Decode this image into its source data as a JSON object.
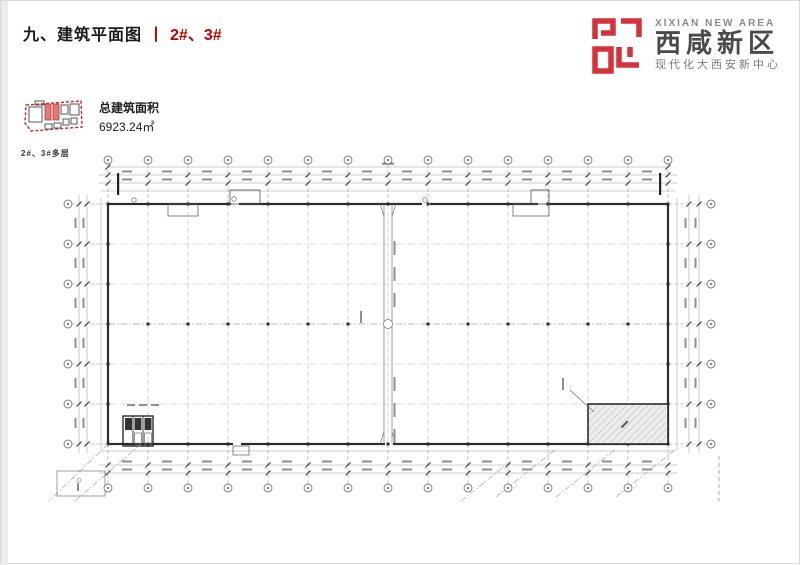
{
  "slide": {
    "title": "九、建筑平面图",
    "title_separator": "丨",
    "title_highlight": "2#、3#",
    "accent_color": "#c00000"
  },
  "logo": {
    "name_en": "XIXIAN NEW AREA",
    "name_cn": "西咸新区",
    "tagline": "现代化大西安新中心",
    "brand_color": "#d4323c"
  },
  "keyplan": {
    "caption": "2#、3#多层",
    "area_label": "总建筑面积",
    "area_value": "6923.24㎡",
    "highlight_color": "#e07a7a",
    "outline_color": "#cc2222"
  },
  "plan": {
    "grid_cols": 15,
    "grid_rows": 7
  }
}
